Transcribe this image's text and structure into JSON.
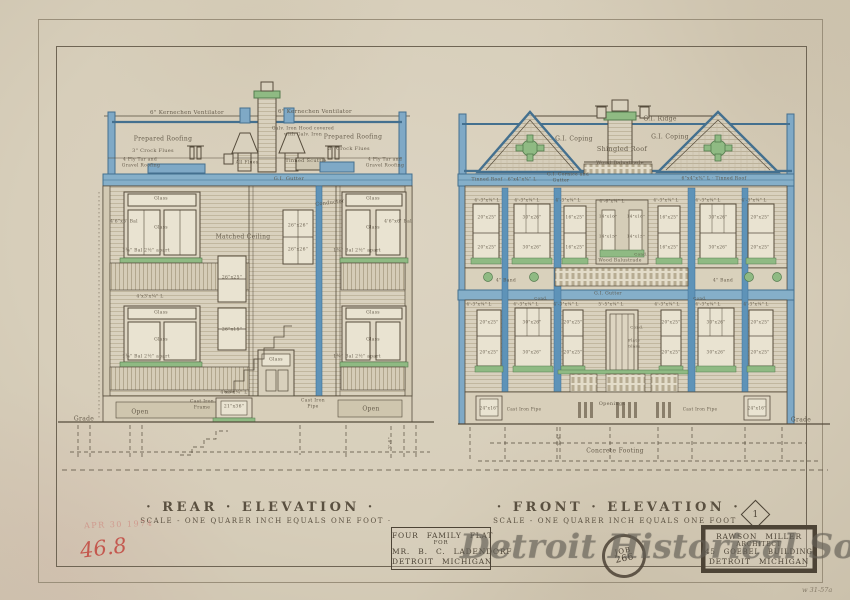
{
  "sheet": {
    "rear_title": "· REAR · ELEVATION ·",
    "rear_scale": "SCALE - ONE QUARER INCH EQUALS ONE FOOT ·",
    "front_title": "· FRONT · ELEVATION ·",
    "front_scale": "SCALE - ONE QUARER INCH EQUALS ONE FOOT",
    "sheet_number": "1"
  },
  "project_block": {
    "line1": "FOUR FAMILY FLAT",
    "line2": "FOR",
    "line3": "MR. B. C. LADENDORF",
    "line4": "DETROIT MICHIGAN"
  },
  "architect_block": {
    "line1": "RAWSON MILLER",
    "line2": "ARCHITECT",
    "line3": "45 GOEBEL BUILDING",
    "line4": "DETROIT MICHIGAN"
  },
  "stamps": {
    "job_line1": "JOB",
    "job_line2": "266",
    "date_stamp": "APR 30 1974",
    "red_note": "46.8",
    "corner_note": "w 31-57a"
  },
  "watermark": "Detroit Historical Society",
  "colors": {
    "paper": "#d7ceba",
    "ink": "#564c3c",
    "blue": "#5e93b8",
    "green": "#8fba83",
    "red": "#c2463e"
  },
  "annotations": [
    {
      "t": "6\" Kernechen Ventilator",
      "x": 187,
      "y": 113,
      "s": 5.5
    },
    {
      "t": "6\" Kernechen Ventilator",
      "x": 315,
      "y": 112,
      "s": 5.5
    },
    {
      "t": "Prepared Roofing",
      "x": 163,
      "y": 139,
      "s": 6
    },
    {
      "t": "Prepared Roofing",
      "x": 353,
      "y": 137,
      "s": 6
    },
    {
      "t": "Galv. Iron Hood covered",
      "x": 303,
      "y": 129,
      "s": 4.5
    },
    {
      "t": "with Galv. Iron",
      "x": 303,
      "y": 135,
      "s": 4.5
    },
    {
      "t": "3\" Crock Flues",
      "x": 153,
      "y": 151,
      "s": 5
    },
    {
      "t": "3\" Crock Flues",
      "x": 349,
      "y": 149,
      "s": 5
    },
    {
      "t": "4 Ply Tar and",
      "x": 140,
      "y": 160,
      "s": 4.5
    },
    {
      "t": "Gravel Roofing",
      "x": 141,
      "y": 166,
      "s": 4.5
    },
    {
      "t": "All Flues",
      "x": 247,
      "y": 163,
      "s": 4.5
    },
    {
      "t": "Tinned Scuttle",
      "x": 306,
      "y": 161,
      "s": 5
    },
    {
      "t": "4 Ply Tar and",
      "x": 385,
      "y": 160,
      "s": 4.5
    },
    {
      "t": "Gravel Roofing",
      "x": 385,
      "y": 166,
      "s": 4.5
    },
    {
      "t": "G.I. Gutter",
      "x": 289,
      "y": 179,
      "s": 5
    },
    {
      "t": "Conductor",
      "x": 330,
      "y": 203,
      "s": 5,
      "r": -7
    },
    {
      "t": "Matched Ceiling",
      "x": 243,
      "y": 237,
      "s": 6
    },
    {
      "t": "Glass",
      "x": 161,
      "y": 199,
      "s": 4.5
    },
    {
      "t": "4'6\"x6' Bal",
      "x": 124,
      "y": 222,
      "s": 4.5
    },
    {
      "t": "Glass",
      "x": 161,
      "y": 228,
      "s": 4.5
    },
    {
      "t": "1¾\" Bal 2½\" apart",
      "x": 146,
      "y": 251,
      "s": 4.5
    },
    {
      "t": "Glass",
      "x": 373,
      "y": 199,
      "s": 4.5
    },
    {
      "t": "4'6\"x6' Bal",
      "x": 398,
      "y": 222,
      "s": 4.5
    },
    {
      "t": "Glass",
      "x": 373,
      "y": 228,
      "s": 4.5
    },
    {
      "t": "1¾\" Bal 2½\" apart",
      "x": 357,
      "y": 251,
      "s": 4.5
    },
    {
      "t": "26\"x26\"",
      "x": 298,
      "y": 226,
      "s": 4.5
    },
    {
      "t": "26\"x26\"",
      "x": 298,
      "y": 250,
      "s": 4.5
    },
    {
      "t": "26\"x25\"",
      "x": 232,
      "y": 278,
      "s": 4.5
    },
    {
      "t": "26\"x15\"",
      "x": 232,
      "y": 330,
      "s": 4.5
    },
    {
      "t": "4'x3'x¼\" L",
      "x": 150,
      "y": 297,
      "s": 4.5
    },
    {
      "t": "Glass",
      "x": 161,
      "y": 313,
      "s": 4.5
    },
    {
      "t": "Glass",
      "x": 161,
      "y": 340,
      "s": 4.5
    },
    {
      "t": "Glass",
      "x": 373,
      "y": 313,
      "s": 4.5
    },
    {
      "t": "Glass",
      "x": 373,
      "y": 340,
      "s": 4.5
    },
    {
      "t": "1¾\" Bal 2½\" apart",
      "x": 146,
      "y": 357,
      "s": 4.5
    },
    {
      "t": "1¾\" Bal 2½\" apart",
      "x": 357,
      "y": 357,
      "s": 4.5
    },
    {
      "t": "Glass",
      "x": 276,
      "y": 360,
      "s": 4.5
    },
    {
      "t": "4'x3'x¼\" L",
      "x": 234,
      "y": 393,
      "s": 4.5
    },
    {
      "t": "Open",
      "x": 140,
      "y": 412,
      "s": 6
    },
    {
      "t": "Open",
      "x": 371,
      "y": 409,
      "s": 6
    },
    {
      "t": "Cast Iron",
      "x": 202,
      "y": 402,
      "s": 4.5
    },
    {
      "t": "Frame",
      "x": 202,
      "y": 408,
      "s": 4.5
    },
    {
      "t": "21\"x36\"",
      "x": 234,
      "y": 407,
      "s": 4.5
    },
    {
      "t": "Cast Iron",
      "x": 313,
      "y": 401,
      "s": 4.5
    },
    {
      "t": "Pipe",
      "x": 313,
      "y": 407,
      "s": 4.5
    },
    {
      "t": "Grade",
      "x": 84,
      "y": 419,
      "s": 6
    },
    {
      "t": "3'-6\"",
      "x": 391,
      "y": 443,
      "s": 4.5,
      "r": -90
    },
    {
      "t": "G.I. Ridge",
      "x": 660,
      "y": 119,
      "s": 6
    },
    {
      "t": "G.I. Coping",
      "x": 574,
      "y": 139,
      "s": 6
    },
    {
      "t": "G.I. Coping",
      "x": 670,
      "y": 137,
      "s": 6
    },
    {
      "t": "Shingled Roof",
      "x": 622,
      "y": 149,
      "s": 6.5
    },
    {
      "t": "Wood Balustrade",
      "x": 620,
      "y": 163,
      "s": 5
    },
    {
      "t": "G.I. Cornice and",
      "x": 568,
      "y": 175,
      "s": 4.5
    },
    {
      "t": "Gutter",
      "x": 561,
      "y": 181,
      "s": 4.5
    },
    {
      "t": "Tinned Roof · 6\"x4\"x⅜\" L",
      "x": 504,
      "y": 180,
      "s": 4.5
    },
    {
      "t": "6\"x4\"x⅜\" L · Tinned Roof",
      "x": 714,
      "y": 179,
      "s": 4.5
    },
    {
      "t": "4'-3\"x¼\" L",
      "x": 487,
      "y": 200,
      "s": 4.2
    },
    {
      "t": "4'-3\"x¼\" L",
      "x": 527,
      "y": 200,
      "s": 4.2
    },
    {
      "t": "4'-3\"x¼\" L",
      "x": 568,
      "y": 200,
      "s": 4.2
    },
    {
      "t": "4'-6\"x¼\" L",
      "x": 612,
      "y": 201,
      "s": 4.2
    },
    {
      "t": "4'-3\"x¼\" L",
      "x": 666,
      "y": 200,
      "s": 4.2
    },
    {
      "t": "4'-3\"x¼\" L",
      "x": 708,
      "y": 200,
      "s": 4.2
    },
    {
      "t": "4'-3\"x¼\" L",
      "x": 754,
      "y": 200,
      "s": 4.2
    },
    {
      "t": "20\"x25\"",
      "x": 487,
      "y": 217,
      "s": 4.2
    },
    {
      "t": "30\"x26\"",
      "x": 532,
      "y": 217,
      "s": 4.2
    },
    {
      "t": "16\"x25\"",
      "x": 575,
      "y": 217,
      "s": 4.2
    },
    {
      "t": "14\"x16\"",
      "x": 608,
      "y": 216,
      "s": 4
    },
    {
      "t": "14\"x16\"",
      "x": 636,
      "y": 216,
      "s": 4
    },
    {
      "t": "16\"x25\"",
      "x": 669,
      "y": 217,
      "s": 4.2
    },
    {
      "t": "30\"x26\"",
      "x": 718,
      "y": 217,
      "s": 4.2
    },
    {
      "t": "20\"x25\"",
      "x": 760,
      "y": 217,
      "s": 4.2
    },
    {
      "t": "20\"x25\"",
      "x": 487,
      "y": 247,
      "s": 4.2
    },
    {
      "t": "30\"x26\"",
      "x": 532,
      "y": 247,
      "s": 4.2
    },
    {
      "t": "16\"x25\"",
      "x": 575,
      "y": 247,
      "s": 4.2
    },
    {
      "t": "14\"x15\"",
      "x": 608,
      "y": 236,
      "s": 4
    },
    {
      "t": "14\"x15\"",
      "x": 636,
      "y": 236,
      "s": 4
    },
    {
      "t": "16\"x25\"",
      "x": 669,
      "y": 247,
      "s": 4.2
    },
    {
      "t": "30\"x26\"",
      "x": 718,
      "y": 247,
      "s": 4.2
    },
    {
      "t": "20\"x25\"",
      "x": 760,
      "y": 247,
      "s": 4.2
    },
    {
      "t": "Wood Balustrade",
      "x": 620,
      "y": 261,
      "s": 4.5
    },
    {
      "t": "Cond.",
      "x": 641,
      "y": 254,
      "s": 4
    },
    {
      "t": "4\" Band",
      "x": 506,
      "y": 281,
      "s": 4.5
    },
    {
      "t": "4\" Band",
      "x": 723,
      "y": 281,
      "s": 4.5
    },
    {
      "t": "G.I. Gutter",
      "x": 608,
      "y": 294,
      "s": 4.5
    },
    {
      "t": "Cond.",
      "x": 541,
      "y": 298,
      "s": 4
    },
    {
      "t": "Cond.",
      "x": 700,
      "y": 298,
      "s": 4
    },
    {
      "t": "4'-3\"x¼\" L",
      "x": 479,
      "y": 304,
      "s": 4.2
    },
    {
      "t": "4'-3\"x¼\" L",
      "x": 526,
      "y": 304,
      "s": 4.2
    },
    {
      "t": "4'-3\"x¼\" L",
      "x": 566,
      "y": 304,
      "s": 4.2
    },
    {
      "t": "5'-5\"x¼\" L",
      "x": 611,
      "y": 304,
      "s": 4.2
    },
    {
      "t": "4'-3\"x¼\" L",
      "x": 667,
      "y": 304,
      "s": 4.2
    },
    {
      "t": "4'-3\"x¼\" L",
      "x": 708,
      "y": 304,
      "s": 4.2
    },
    {
      "t": "4'-3\"x¼\" L",
      "x": 756,
      "y": 304,
      "s": 4.2
    },
    {
      "t": "Cond.",
      "x": 637,
      "y": 327,
      "s": 4
    },
    {
      "t": "20\"x25\"",
      "x": 489,
      "y": 322,
      "s": 4.2
    },
    {
      "t": "30\"x26\"",
      "x": 532,
      "y": 322,
      "s": 4.2
    },
    {
      "t": "20\"x25\"",
      "x": 573,
      "y": 322,
      "s": 4.2
    },
    {
      "t": "20\"x25\"",
      "x": 671,
      "y": 322,
      "s": 4.2
    },
    {
      "t": "30\"x26\"",
      "x": 716,
      "y": 322,
      "s": 4.2
    },
    {
      "t": "20\"x25\"",
      "x": 760,
      "y": 322,
      "s": 4.2
    },
    {
      "t": "20\"x25\"",
      "x": 489,
      "y": 352,
      "s": 4.2
    },
    {
      "t": "30\"x26\"",
      "x": 532,
      "y": 352,
      "s": 4.2
    },
    {
      "t": "20\"x25\"",
      "x": 573,
      "y": 352,
      "s": 4.2
    },
    {
      "t": "Plate",
      "x": 634,
      "y": 340,
      "s": 4
    },
    {
      "t": "Glass",
      "x": 634,
      "y": 346,
      "s": 4
    },
    {
      "t": "20\"x25\"",
      "x": 671,
      "y": 352,
      "s": 4.2
    },
    {
      "t": "30\"x26\"",
      "x": 716,
      "y": 352,
      "s": 4.2
    },
    {
      "t": "20\"x25\"",
      "x": 760,
      "y": 352,
      "s": 4.2
    },
    {
      "t": "Openings",
      "x": 612,
      "y": 404,
      "s": 5
    },
    {
      "t": "Cast Iron Pipe",
      "x": 524,
      "y": 409,
      "s": 4.2
    },
    {
      "t": "Cast Iron Pipe",
      "x": 700,
      "y": 409,
      "s": 4.2
    },
    {
      "t": "24\"x16\"",
      "x": 489,
      "y": 408,
      "s": 4.2
    },
    {
      "t": "24\"x16\"",
      "x": 757,
      "y": 408,
      "s": 4.2
    },
    {
      "t": "Grade",
      "x": 801,
      "y": 420,
      "s": 6
    },
    {
      "t": "Concrete Footing",
      "x": 615,
      "y": 451,
      "s": 6
    },
    {
      "t": "3'-6\"",
      "x": 560,
      "y": 440,
      "s": 4.5,
      "r": -90
    }
  ]
}
